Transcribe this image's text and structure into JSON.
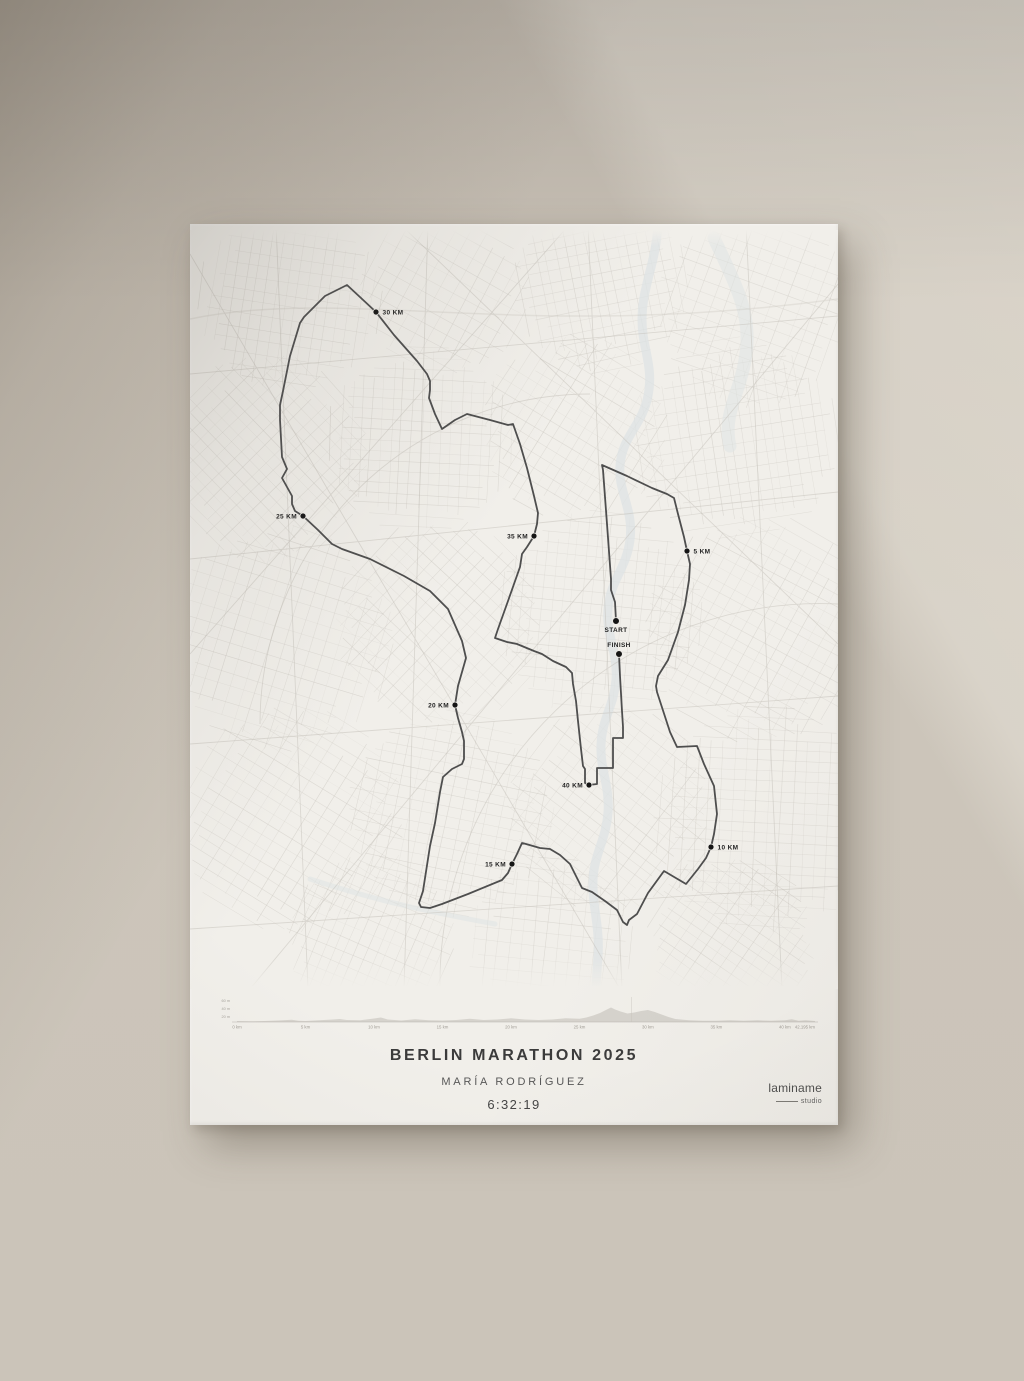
{
  "poster": {
    "title": "BERLIN MARATHON 2025",
    "runner_name": "MARÍA RODRÍGUEZ",
    "finish_time": "6:32:19",
    "brand": {
      "name": "laminame",
      "sub": "studio"
    }
  },
  "map": {
    "route_color": "#4e4e4e",
    "marker_color": "#151515",
    "markers": [
      {
        "id": "start",
        "label": "START",
        "x": 426,
        "y": 397,
        "side": "below"
      },
      {
        "id": "finish",
        "label": "FINISH",
        "x": 429,
        "y": 430,
        "side": "above"
      },
      {
        "id": "km5",
        "label": "5 KM",
        "x": 497,
        "y": 327,
        "side": "right"
      },
      {
        "id": "km10",
        "label": "10 KM",
        "x": 521,
        "y": 623,
        "side": "right"
      },
      {
        "id": "km15",
        "label": "15 KM",
        "x": 322,
        "y": 640,
        "side": "left"
      },
      {
        "id": "km20",
        "label": "20 KM",
        "x": 265,
        "y": 481,
        "side": "left"
      },
      {
        "id": "km25",
        "label": "25 KM",
        "x": 113,
        "y": 292,
        "side": "left"
      },
      {
        "id": "km30",
        "label": "30 KM",
        "x": 186,
        "y": 88,
        "side": "right"
      },
      {
        "id": "km35",
        "label": "35 KM",
        "x": 344,
        "y": 312,
        "side": "left"
      },
      {
        "id": "km40",
        "label": "40 KM",
        "x": 399,
        "y": 561,
        "side": "left"
      }
    ],
    "route_points": [
      [
        426,
        397
      ],
      [
        425,
        378
      ],
      [
        421,
        366
      ],
      [
        421,
        355
      ],
      [
        417,
        300
      ],
      [
        413,
        246
      ],
      [
        412,
        241
      ],
      [
        437,
        252
      ],
      [
        462,
        264
      ],
      [
        477,
        270
      ],
      [
        484,
        274
      ],
      [
        488,
        290
      ],
      [
        494,
        313
      ],
      [
        497,
        327
      ],
      [
        500,
        340
      ],
      [
        499,
        356
      ],
      [
        495,
        381
      ],
      [
        488,
        408
      ],
      [
        478,
        436
      ],
      [
        468,
        452
      ],
      [
        466,
        462
      ],
      [
        467,
        468
      ],
      [
        480,
        508
      ],
      [
        487,
        523
      ],
      [
        507,
        522
      ],
      [
        514,
        540
      ],
      [
        524,
        562
      ],
      [
        527,
        590
      ],
      [
        524,
        610
      ],
      [
        521,
        623
      ],
      [
        516,
        634
      ],
      [
        508,
        645
      ],
      [
        496,
        660
      ],
      [
        474,
        647
      ],
      [
        458,
        669
      ],
      [
        447,
        690
      ],
      [
        439,
        696
      ],
      [
        437,
        701
      ],
      [
        433,
        698
      ],
      [
        427,
        686
      ],
      [
        415,
        677
      ],
      [
        402,
        668
      ],
      [
        392,
        664
      ],
      [
        380,
        640
      ],
      [
        370,
        631
      ],
      [
        360,
        625
      ],
      [
        350,
        624
      ],
      [
        336,
        620
      ],
      [
        332,
        619
      ],
      [
        327,
        630
      ],
      [
        322,
        640
      ],
      [
        318,
        649
      ],
      [
        312,
        656
      ],
      [
        278,
        670
      ],
      [
        252,
        680
      ],
      [
        240,
        684
      ],
      [
        231,
        683
      ],
      [
        229,
        679
      ],
      [
        233,
        667
      ],
      [
        240,
        622
      ],
      [
        245,
        599
      ],
      [
        250,
        568
      ],
      [
        253,
        553
      ],
      [
        262,
        545
      ],
      [
        272,
        540
      ],
      [
        274,
        535
      ],
      [
        274,
        517
      ],
      [
        272,
        508
      ],
      [
        268,
        494
      ],
      [
        265,
        481
      ],
      [
        268,
        462
      ],
      [
        276,
        434
      ],
      [
        272,
        417
      ],
      [
        258,
        385
      ],
      [
        240,
        367
      ],
      [
        214,
        352
      ],
      [
        180,
        335
      ],
      [
        152,
        325
      ],
      [
        142,
        320
      ],
      [
        128,
        306
      ],
      [
        113,
        292
      ],
      [
        105,
        287
      ],
      [
        102,
        280
      ],
      [
        102,
        272
      ],
      [
        92,
        254
      ],
      [
        97,
        245
      ],
      [
        92,
        233
      ],
      [
        90,
        196
      ],
      [
        90,
        181
      ],
      [
        93,
        167
      ],
      [
        100,
        132
      ],
      [
        110,
        99
      ],
      [
        114,
        93
      ],
      [
        135,
        72
      ],
      [
        157,
        61
      ],
      [
        171,
        74
      ],
      [
        186,
        88
      ],
      [
        204,
        111
      ],
      [
        227,
        137
      ],
      [
        237,
        150
      ],
      [
        240,
        157
      ],
      [
        240,
        166
      ],
      [
        239,
        174
      ],
      [
        245,
        190
      ],
      [
        252,
        205
      ],
      [
        265,
        196
      ],
      [
        277,
        190
      ],
      [
        300,
        196
      ],
      [
        318,
        201
      ],
      [
        323,
        200
      ],
      [
        330,
        220
      ],
      [
        337,
        244
      ],
      [
        344,
        272
      ],
      [
        348,
        289
      ],
      [
        347,
        300
      ],
      [
        344,
        312
      ],
      [
        337,
        323
      ],
      [
        332,
        330
      ],
      [
        330,
        343
      ],
      [
        324,
        360
      ],
      [
        318,
        377
      ],
      [
        308,
        405
      ],
      [
        305,
        414
      ],
      [
        317,
        418
      ],
      [
        327,
        420
      ],
      [
        344,
        427
      ],
      [
        352,
        430
      ],
      [
        363,
        437
      ],
      [
        376,
        443
      ],
      [
        382,
        449
      ],
      [
        383,
        460
      ],
      [
        386,
        477
      ],
      [
        388,
        497
      ],
      [
        391,
        525
      ],
      [
        393,
        542
      ],
      [
        395,
        545
      ],
      [
        395,
        559
      ],
      [
        399,
        561
      ],
      [
        407,
        560
      ],
      [
        407,
        544
      ],
      [
        423,
        544
      ],
      [
        423,
        514
      ],
      [
        433,
        514
      ],
      [
        433,
        503
      ],
      [
        432,
        487
      ],
      [
        430,
        452
      ],
      [
        429,
        430
      ]
    ]
  },
  "chart_data": {
    "type": "area",
    "title": "Elevation profile",
    "x_unit": "km",
    "y_unit": "m",
    "x_range": [
      0,
      42.195
    ],
    "baseline_m": 36,
    "x_ticks": [
      {
        "km": 0,
        "label": "0 km"
      },
      {
        "km": 5,
        "label": "5 km"
      },
      {
        "km": 10,
        "label": "10 km"
      },
      {
        "km": 15,
        "label": "15 km"
      },
      {
        "km": 20,
        "label": "20 km"
      },
      {
        "km": 25,
        "label": "25 km"
      },
      {
        "km": 30,
        "label": "30 km"
      },
      {
        "km": 35,
        "label": "35 km"
      },
      {
        "km": 40,
        "label": "40 km"
      },
      {
        "km": 42.195,
        "label": "42.195 km"
      }
    ],
    "y_tick_labels": [
      "60 m",
      "40 m",
      "20 m"
    ],
    "x_km": [
      0,
      1,
      2,
      3,
      4,
      4.5,
      5,
      6,
      7,
      7.5,
      8,
      9,
      10,
      10.5,
      11,
      12,
      13,
      14,
      15,
      16,
      17,
      18,
      19,
      20,
      21,
      22,
      23,
      24,
      25,
      25.5,
      26,
      26.5,
      27,
      27.3,
      27.6,
      28,
      28.5,
      29,
      29.5,
      30,
      30.5,
      31,
      31.5,
      32,
      33,
      34,
      35,
      36,
      37,
      38,
      39,
      40,
      40.5,
      41,
      41.5,
      42.195
    ],
    "elevation_m": [
      37,
      36.5,
      37,
      38,
      39.5,
      37.5,
      37,
      38.5,
      40,
      41,
      39,
      38.5,
      42,
      44,
      40,
      38,
      40.5,
      38.5,
      38,
      39,
      41.5,
      39,
      40,
      42.5,
      40,
      39,
      40,
      42.5,
      41.5,
      44,
      48,
      53,
      60,
      64,
      60,
      56,
      52,
      54,
      57,
      59,
      55,
      50,
      45,
      41,
      38.5,
      37.5,
      37.5,
      38.5,
      37.5,
      38.5,
      37.5,
      38.5,
      40.5,
      37.5,
      38.5,
      37
    ]
  }
}
